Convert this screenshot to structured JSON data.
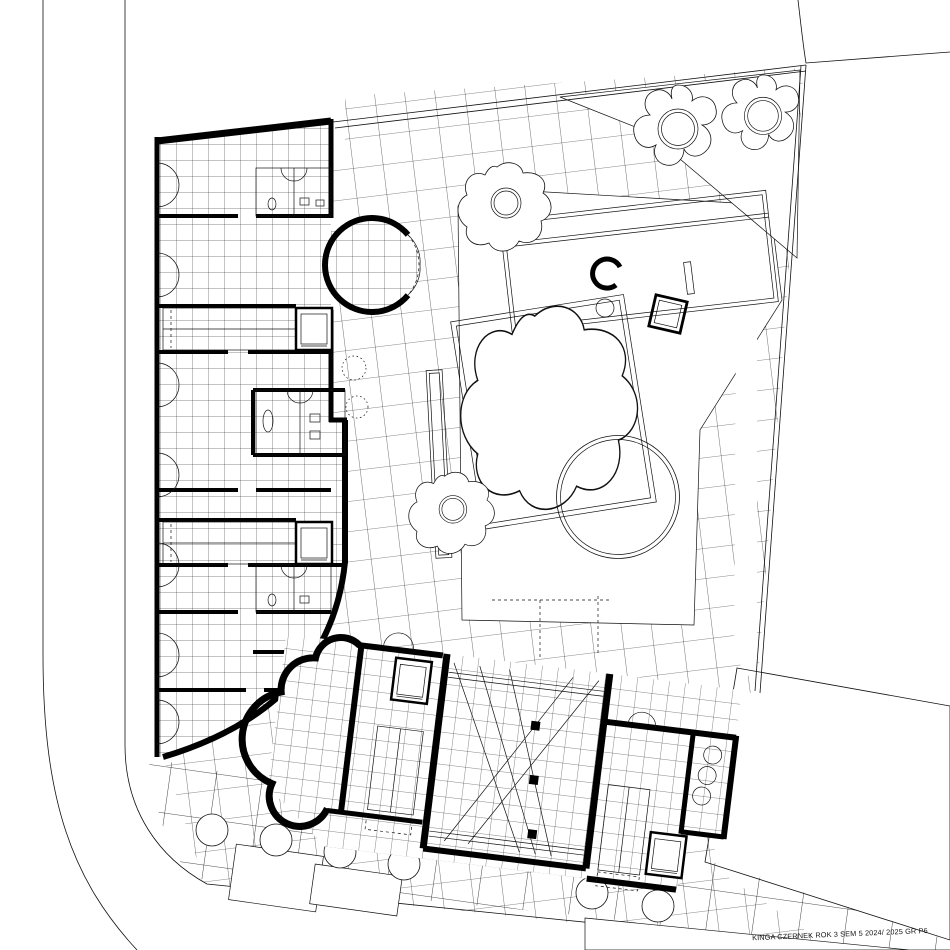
{
  "drawing": {
    "caption": "KINGA CZERNEK ROK 3 SEM 5 2024/ 2025 GR P6",
    "colors": {
      "line": "#111111",
      "wall": "#000000",
      "background": "#ffffff"
    }
  }
}
